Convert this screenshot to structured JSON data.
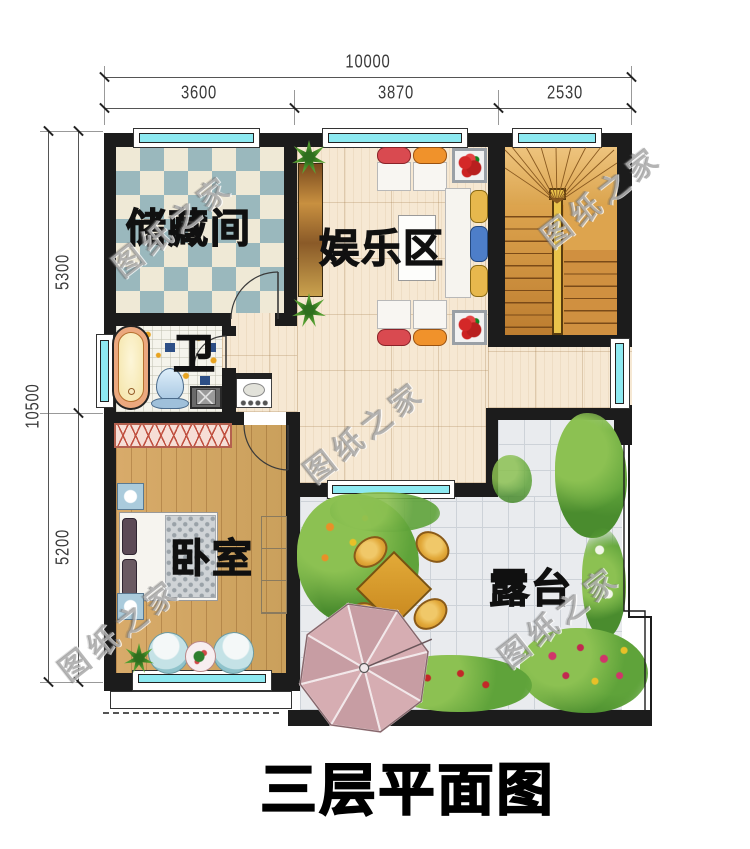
{
  "title": "三层平面图",
  "watermark": {
    "text": "图纸之家"
  },
  "rooms": {
    "storage": {
      "label": "储藏间"
    },
    "entertainment": {
      "label": "娱乐区"
    },
    "bathroom": {
      "label": "卫"
    },
    "bedroom": {
      "label": "卧室"
    },
    "terrace": {
      "label": "露台"
    }
  },
  "dimensions": {
    "top": {
      "total": "10000",
      "segments": [
        "3600",
        "3870",
        "2530"
      ]
    },
    "left": {
      "total": "10500",
      "segments": [
        "5300",
        "5200"
      ]
    }
  },
  "colors": {
    "wall": "#1c1c1c",
    "window_glass": "#8de9f1",
    "checker_blue": "#9ab8bd",
    "checker_cream": "#efe9d6",
    "wood_pale": "#f6e8d3",
    "wood_bedroom": "#d2a262",
    "stairs_wood": "#d5973f",
    "terrace_tile": "#e9ebee",
    "umbrella_pink": "#d0a4aa",
    "seat_red": "#d94a50",
    "seat_orange": "#f0922b",
    "cushion_blue": "#4d7ec9",
    "cushion_yellow": "#e7b84d"
  }
}
